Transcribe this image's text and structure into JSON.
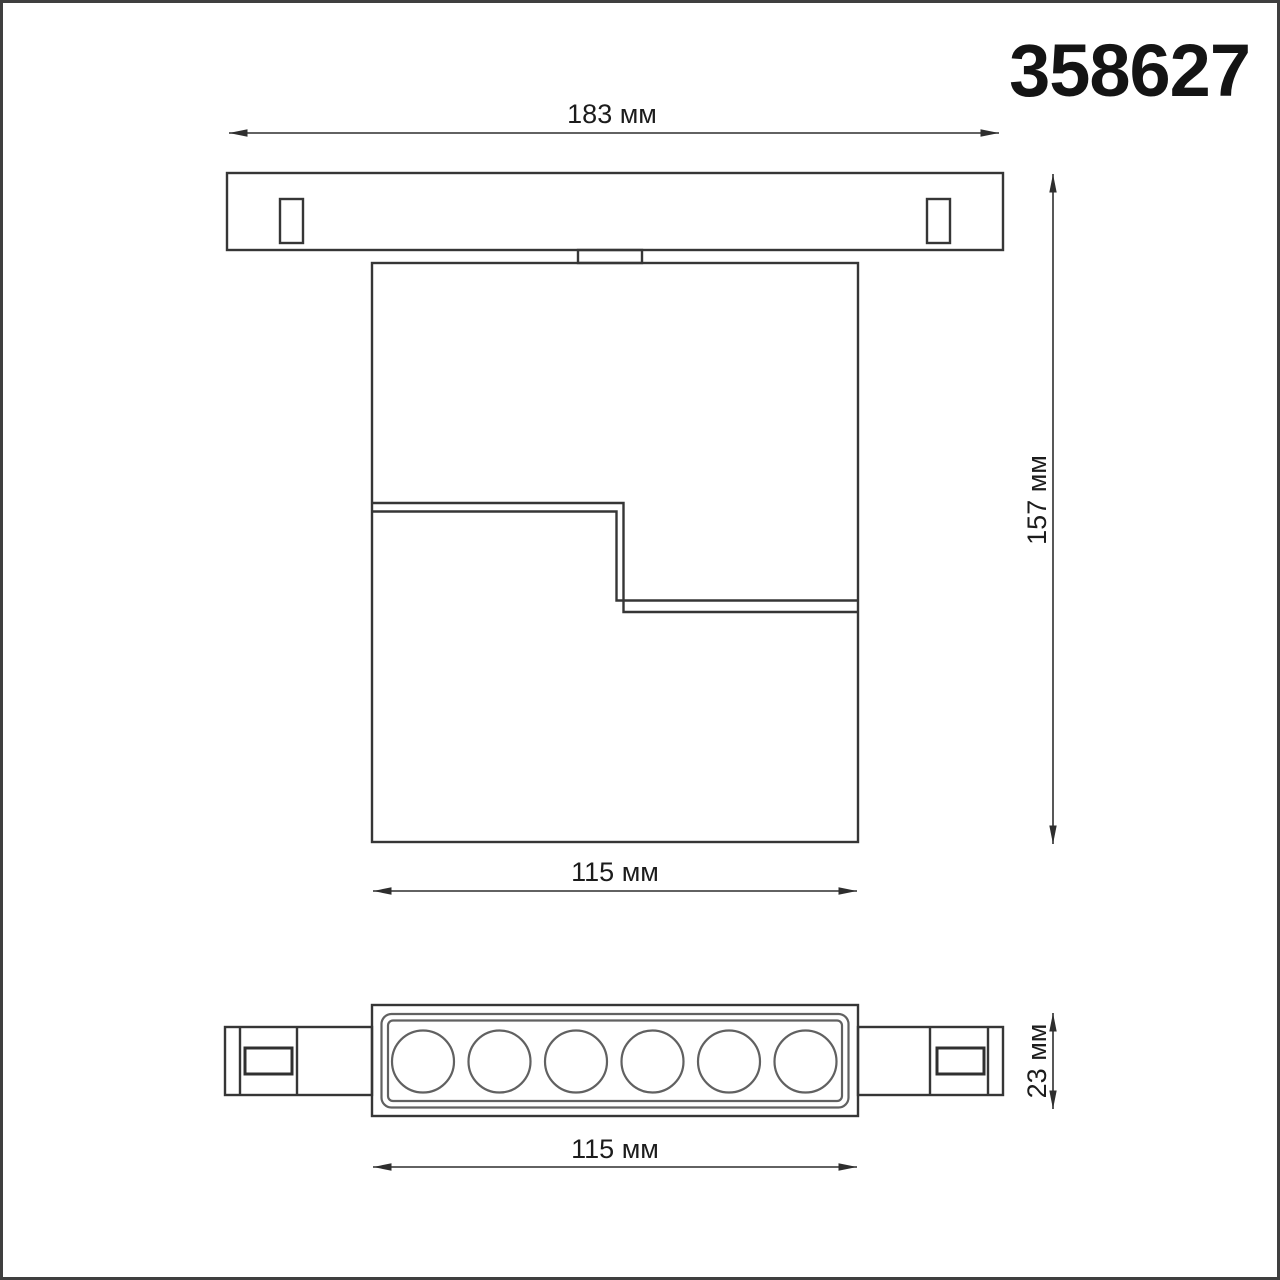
{
  "title": "358627",
  "drawing": {
    "type": "technical-dimension-drawing",
    "views": [
      "front-view",
      "bottom-view"
    ],
    "unit": "мм"
  },
  "dimensions": [
    {
      "id": "track-length",
      "label": "183 мм",
      "orientation": "horizontal"
    },
    {
      "id": "overall-height",
      "label": "157 мм",
      "orientation": "vertical"
    },
    {
      "id": "body-width",
      "label": "115 мм",
      "orientation": "horizontal"
    },
    {
      "id": "profile-height",
      "label": "23 мм",
      "orientation": "vertical"
    },
    {
      "id": "body-width-bottom",
      "label": "115 мм",
      "orientation": "horizontal"
    }
  ],
  "bottom_view": {
    "lens_count": 6
  },
  "colors": {
    "background": "#ffffff",
    "outline": "#363636",
    "dimension_line": "#2e2e2e",
    "lens_circle": "#616161",
    "text": "#1c1c1c",
    "page_border": "#3f3f3f"
  }
}
